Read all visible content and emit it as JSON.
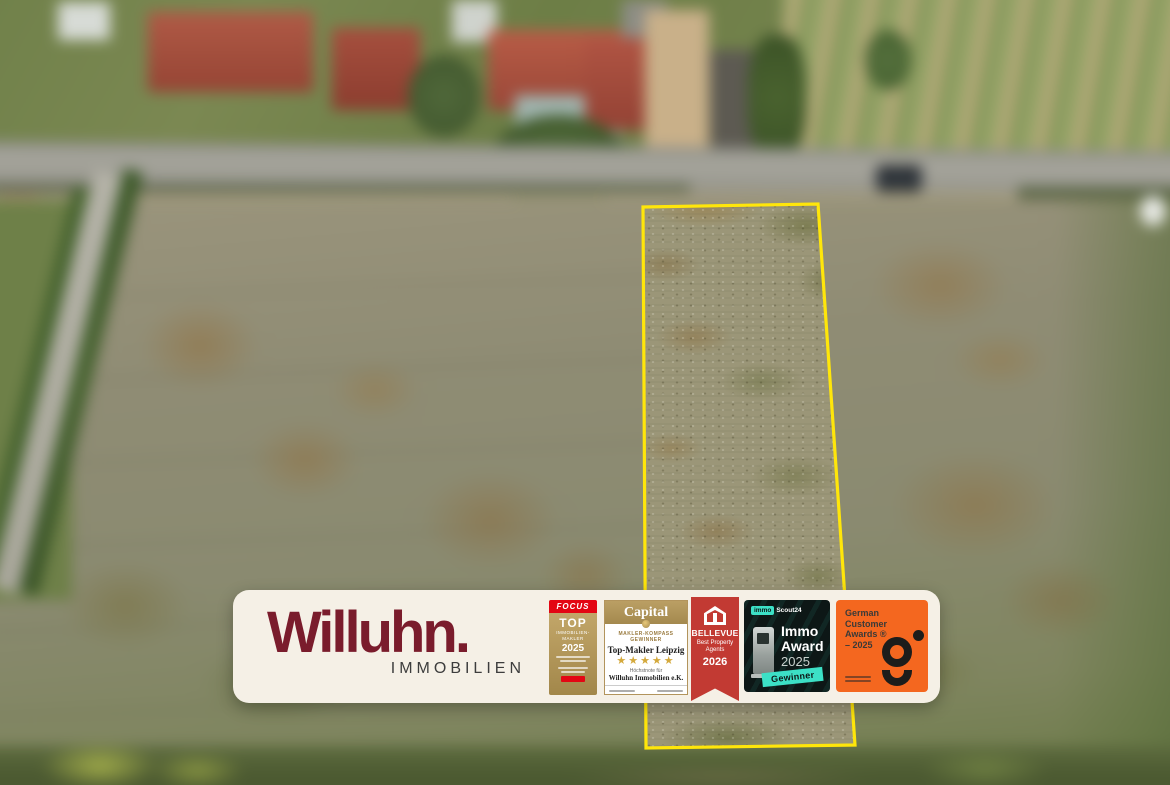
{
  "scene": {
    "type": "aerial-drone-photo",
    "parcel_outline_color": "#ffe60a",
    "blurred_surroundings": true
  },
  "banner": {
    "background_color": "#f5f0e6",
    "brand": {
      "wordmark": "Willuhn.",
      "tagline": "IMMOBILIEN",
      "color": "#7a1c2c"
    },
    "badges": {
      "focus": {
        "header": "FOCUS",
        "top": "TOP",
        "line1": "IMMOBILIEN-",
        "line2": "MAKLER",
        "year": "2025",
        "accent": "#e30613",
        "gold": "#b3985c"
      },
      "capital": {
        "title": "Capital",
        "kicker1": "MAKLER-KOMPASS",
        "kicker2": "GEWINNER",
        "headline": "Top-Makler Leipzig",
        "stars": "★★★★★",
        "note": "Höchstnote für",
        "company": "Willuhn Immobilien e.K.",
        "gold": "#b2945c"
      },
      "bellevue": {
        "title": "BELLEVUE",
        "line1": "Best Property",
        "line2": "Agents",
        "year": "2026",
        "red": "#c23a33"
      },
      "immoscout": {
        "logo_immo": "immo",
        "logo_scout": "Scout24",
        "award1": "Immo",
        "award2": "Award",
        "year": "2025",
        "ribbon": "Gewinner",
        "teal": "#3ce0c6",
        "dark": "#0d1716"
      },
      "gca": {
        "line1": "German",
        "line2": "Customer",
        "line3": "Awards ®",
        "line4": "– 2025",
        "orange": "#f4671f"
      }
    }
  }
}
